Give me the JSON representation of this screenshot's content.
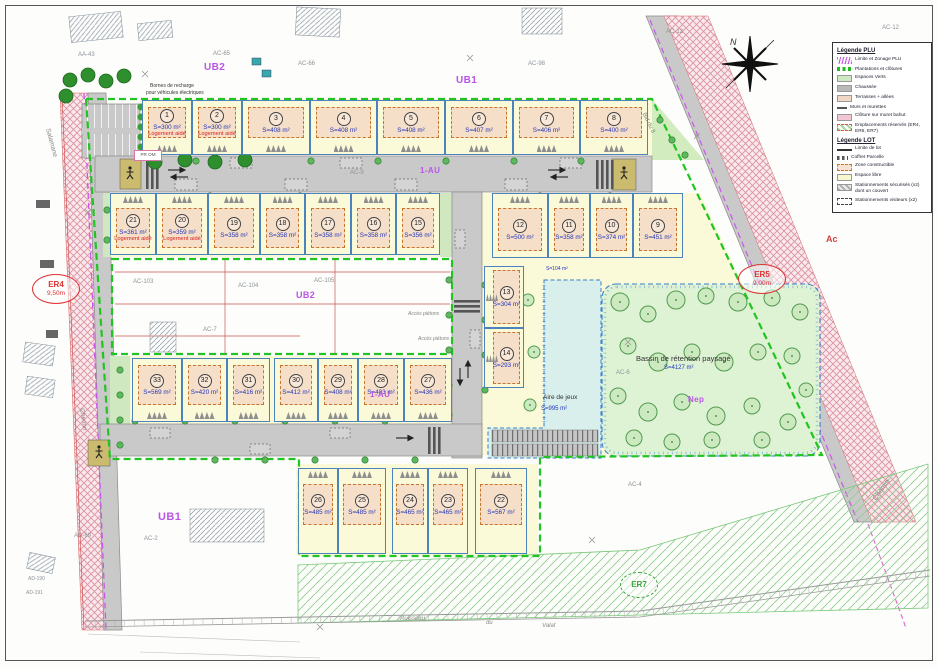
{
  "legend": {
    "sections": [
      {
        "title": "Légende PLU",
        "items": [
          {
            "sw": "zigzag",
            "label": "Limite et Zonage PLU"
          },
          {
            "sw": "gdash",
            "label": "Plantations et clôtures"
          },
          {
            "sw": "green",
            "label": "Espaces Verts"
          },
          {
            "sw": "gray",
            "label": "Chaussée"
          },
          {
            "sw": "peach",
            "label": "Terrasses + allées"
          },
          {
            "sw": "wall",
            "label": "Murs et murettes"
          },
          {
            "sw": "pink",
            "label": "Clôture sur muret bahut"
          },
          {
            "sw": "er",
            "label": "Emplacements réservés (ER4, ER5, ER7)"
          }
        ]
      },
      {
        "title": "Légende LOT",
        "items": [
          {
            "sw": "line",
            "label": "Limite de lot"
          },
          {
            "sw": "coffret",
            "label": "Coffret Parcelle"
          },
          {
            "sw": "zc",
            "label": "Zone constructible"
          },
          {
            "sw": "libre",
            "label": "Espace libre"
          },
          {
            "sw": "park",
            "label": "Stationnements sécurisés (x2) dont un couvert"
          },
          {
            "sw": "visit",
            "label": "Stationnements visiteurs (x2)"
          }
        ]
      }
    ]
  },
  "zones": {
    "ub2_top": "UB2",
    "ub1_top": "UB1",
    "ub2_mid": "UB2",
    "ub1_bottom": "UB1",
    "au_road": "1-AU",
    "au_lot28": "1-AU",
    "nep": "Nep",
    "ac": "Ac"
  },
  "reserves": {
    "er4": {
      "name": "ER4",
      "dim": "9,50m"
    },
    "er5": {
      "name": "ER5",
      "dim": "9,00m"
    },
    "er7": {
      "name": "ER7"
    }
  },
  "features": {
    "basin_name": "Bassin de rétention paysagé",
    "basin_area": "S=4127 m²",
    "play_name": "Aire de jeux",
    "play_area": "S=995 m²",
    "strip_area": "S=104 m²",
    "charging_1": "Bornes de recharge",
    "charging_2": "pour véhicules électriques",
    "waste_point": "PR OM",
    "access_1": "Accès piétons",
    "access_2": "Accès piétons",
    "north": "N"
  },
  "parcels": {
    "aa43": "AA-43",
    "ac65": "AC-65",
    "ac66": "AC-66",
    "ac98": "AC-98",
    "ac12a": "AC-12",
    "ac12b": "AC-12",
    "ac103": "AC-103",
    "ac104": "AC-104",
    "ac105": "AC-105",
    "ac7": "AC-7",
    "ac9": "AC-9",
    "ac2": "AC-2",
    "ac4": "AC-4",
    "ac6": "AC-6",
    "ad69": "AD-69",
    "ad190": "AD-190",
    "ad191": "AD-191"
  },
  "streets": {
    "salamane": "Salamane",
    "chemin_left": "Chemin",
    "chemin_br": "Chemin",
    "bld": "Bld du 8",
    "ruisseau": "Ruisseau",
    "du": "du",
    "valat": "Valat"
  },
  "lots": [
    {
      "num": "1",
      "area": "S=300 m²",
      "note": "Logement aidé"
    },
    {
      "num": "2",
      "area": "S=300 m²",
      "note": "Logement aidé"
    },
    {
      "num": "3",
      "area": "S=408 m²"
    },
    {
      "num": "4",
      "area": "S=408 m²"
    },
    {
      "num": "5",
      "area": "S=408 m²"
    },
    {
      "num": "6",
      "area": "S=407 m²"
    },
    {
      "num": "7",
      "area": "S=406 m²"
    },
    {
      "num": "8",
      "area": "S=400 m²"
    },
    {
      "num": "9",
      "area": "S=451 m²"
    },
    {
      "num": "10",
      "area": "S=374 m²"
    },
    {
      "num": "11",
      "area": "S=358 m²"
    },
    {
      "num": "12",
      "area": "S=500 m²"
    },
    {
      "num": "13",
      "area": "S=304 m²"
    },
    {
      "num": "14",
      "area": "S=293 m²"
    },
    {
      "num": "15",
      "area": "S=356 m²"
    },
    {
      "num": "16",
      "area": "S=358 m²"
    },
    {
      "num": "17",
      "area": "S=358 m²"
    },
    {
      "num": "18",
      "area": "S=358 m²"
    },
    {
      "num": "19",
      "area": "S=358 m²"
    },
    {
      "num": "20",
      "area": "S=359 m²",
      "note": "Logement aidé"
    },
    {
      "num": "21",
      "area": "S=361 m²",
      "note": "Logement aidé"
    },
    {
      "num": "22",
      "area": "S=567 m²"
    },
    {
      "num": "23",
      "area": "S=465 m²"
    },
    {
      "num": "24",
      "area": "S=465 m²"
    },
    {
      "num": "25",
      "area": "S=485 m²"
    },
    {
      "num": "26",
      "area": "S=485 m²"
    },
    {
      "num": "27",
      "area": "S=436 m²"
    },
    {
      "num": "28",
      "area": "S=403 m²"
    },
    {
      "num": "29",
      "area": "S=408 m²"
    },
    {
      "num": "30",
      "area": "S=412 m²"
    },
    {
      "num": "31",
      "area": "S=416 m²"
    },
    {
      "num": "32",
      "area": "S=420 m²"
    },
    {
      "num": "33",
      "area": "S=569 m²"
    }
  ],
  "colors": {
    "site_boundary": "#21c421",
    "plu_limit": "#cc55ee",
    "zone_label": "#bb55e6",
    "lot_line": "#4d83bd",
    "area_text": "#2335bb",
    "aided_text": "#d82222",
    "er_red": "#dd3333",
    "er7_green": "#3aa53a",
    "road": "#c9c9c9",
    "buildable_pad": "#f6dfc8",
    "parcel_fill": "#fafad8",
    "basin": "#def2d4",
    "playground": "#d8efec",
    "reserve_hatch": "#dc93a2"
  }
}
